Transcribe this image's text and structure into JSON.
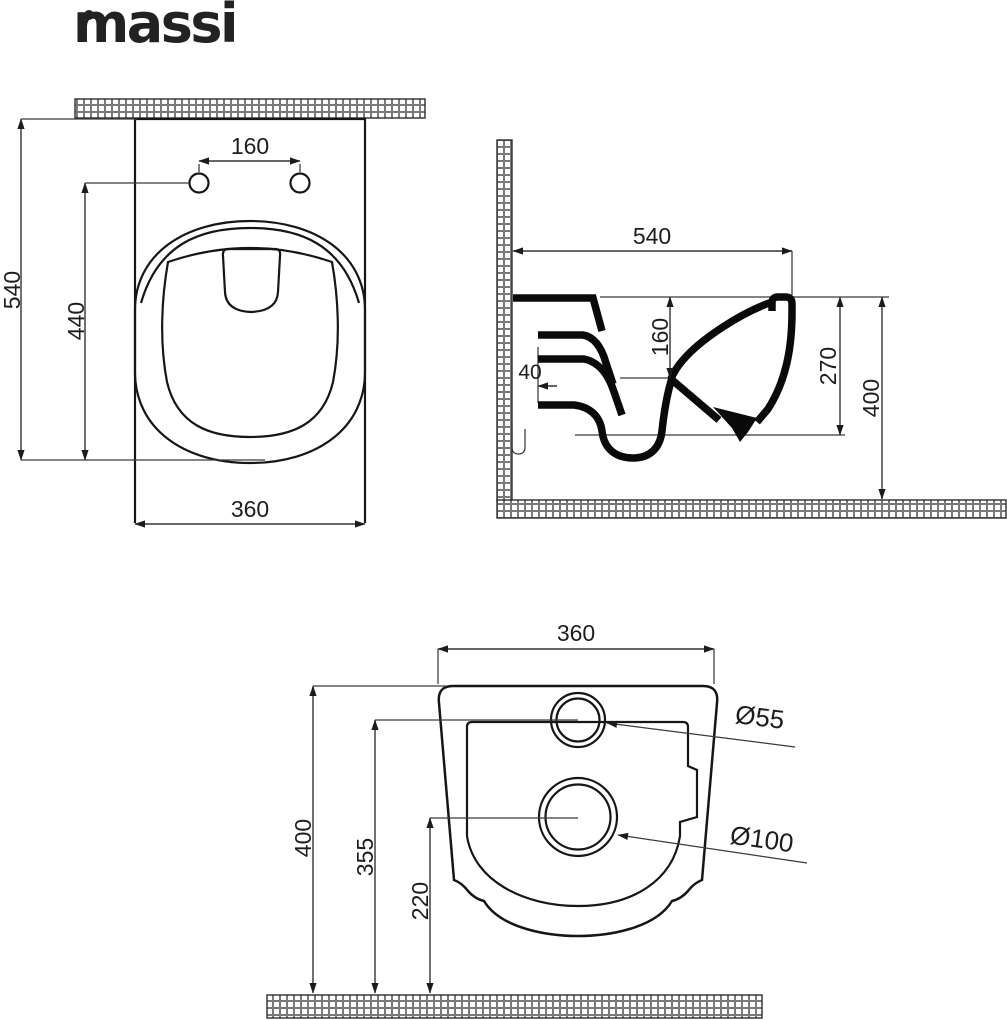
{
  "brand": {
    "logo": "massi"
  },
  "drawing_title": "wall-hung WC installation dimensions (mm)",
  "colors": {
    "ink": "#161616",
    "dim_lines": "#343434",
    "background": "#ffffff"
  },
  "dims": {
    "top": {
      "hole_spacing": "160",
      "total_depth": "540",
      "hole_depth": "440",
      "width": "360"
    },
    "side": {
      "depth": "540",
      "rim_drop": "160",
      "wall_gap": "40",
      "trap_height": "270",
      "height": "400"
    },
    "rear": {
      "width": "360",
      "height": "400",
      "inlet_height": "355",
      "drain_height": "220",
      "inlet_dia": "Ø55",
      "drain_dia": "Ø100"
    }
  }
}
